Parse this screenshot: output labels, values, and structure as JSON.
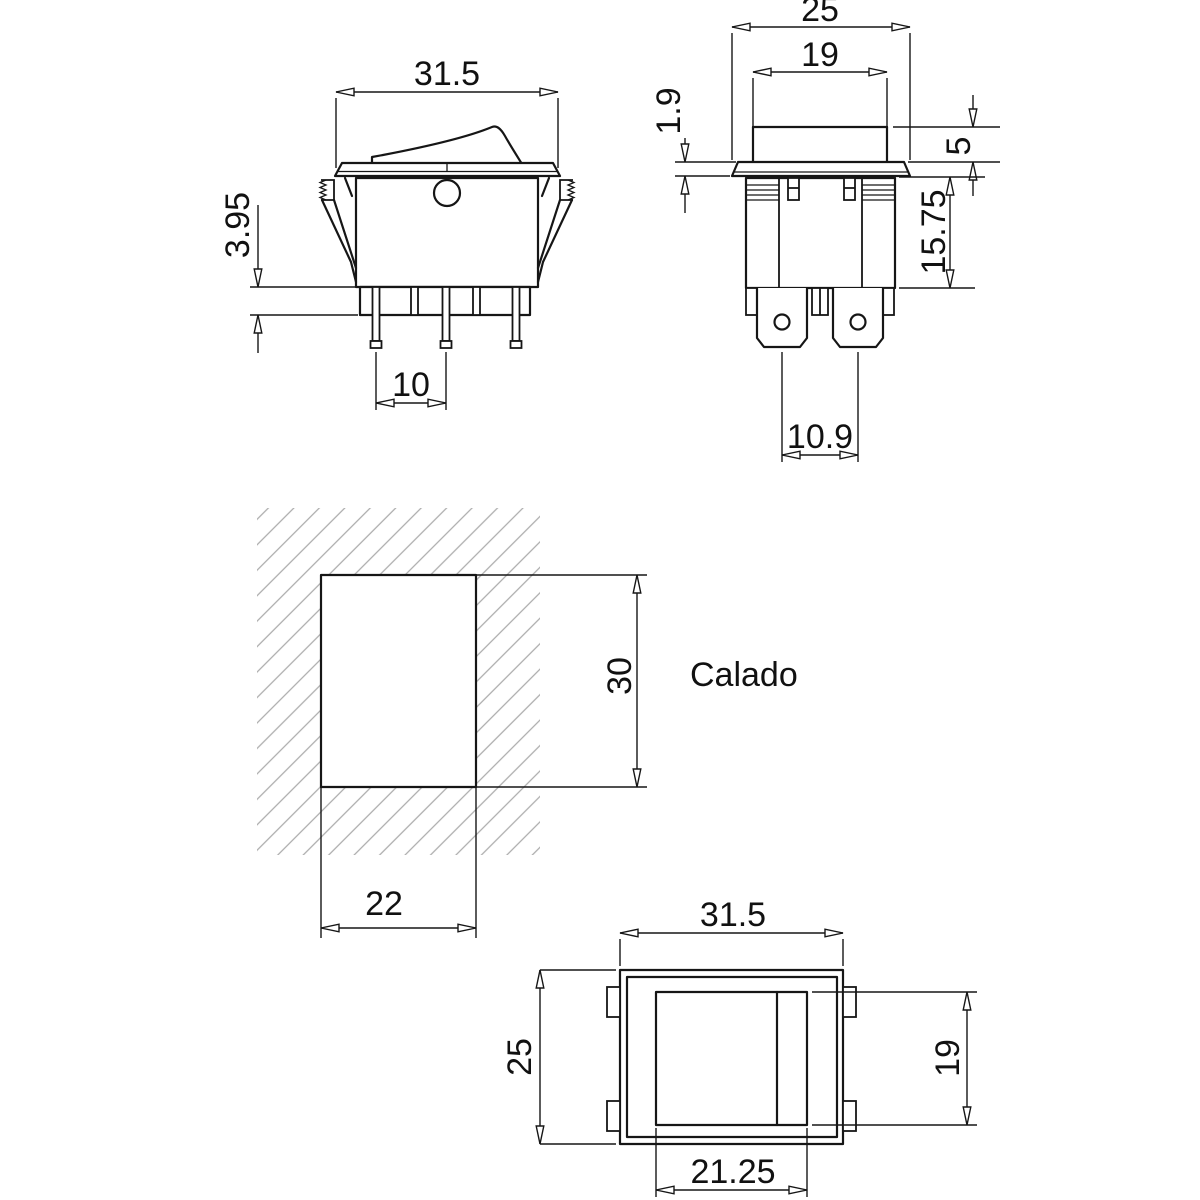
{
  "drawing": {
    "background_color": "#ffffff",
    "line_color": "#161616",
    "hatch_color": "#ababab",
    "side_view": {
      "width": "31.5",
      "terminal_height": "3.95",
      "pin_pitch": "10"
    },
    "front_view": {
      "bezel_width": "25",
      "rocker_width": "19",
      "bezel_thickness": "1.9",
      "rocker_height": "5",
      "body_height": "15.75",
      "terminal_pitch": "10.9"
    },
    "cutout_view": {
      "label": "Calado",
      "height": "30",
      "width": "22"
    },
    "top_view": {
      "width": "31.5",
      "depth": "25",
      "opening_height": "19",
      "opening_width": "21.25"
    }
  }
}
